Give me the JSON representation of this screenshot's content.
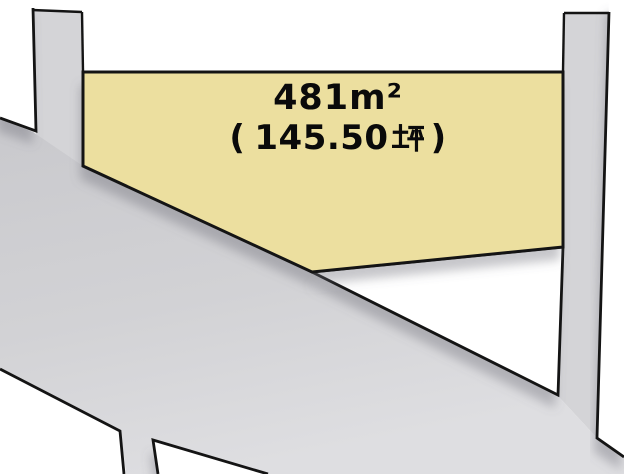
{
  "diagram": {
    "type": "land-plot-map",
    "background": "#ffffff"
  },
  "plot": {
    "area_label": "481㎡",
    "area_label_ascii": "481m²",
    "tsubo_label": "（145.50坪）",
    "tsubo_open": "(",
    "tsubo_value": "145.50",
    "tsubo_unit": "坪",
    "tsubo_close": ")",
    "fill": "#ecdf9f",
    "border": "#141414",
    "text_color": "#0a0a0a"
  },
  "roads": {
    "fill": "#d4d4d7",
    "fill_dark": "#c9c9cd",
    "fill_mid": "#d2d2d5",
    "fill_light": "#dedee1",
    "edge_color": "#141414"
  },
  "neighbors": {
    "fill": "#ffffff",
    "border": "#141414",
    "shadow_color": "#6b6b76"
  }
}
